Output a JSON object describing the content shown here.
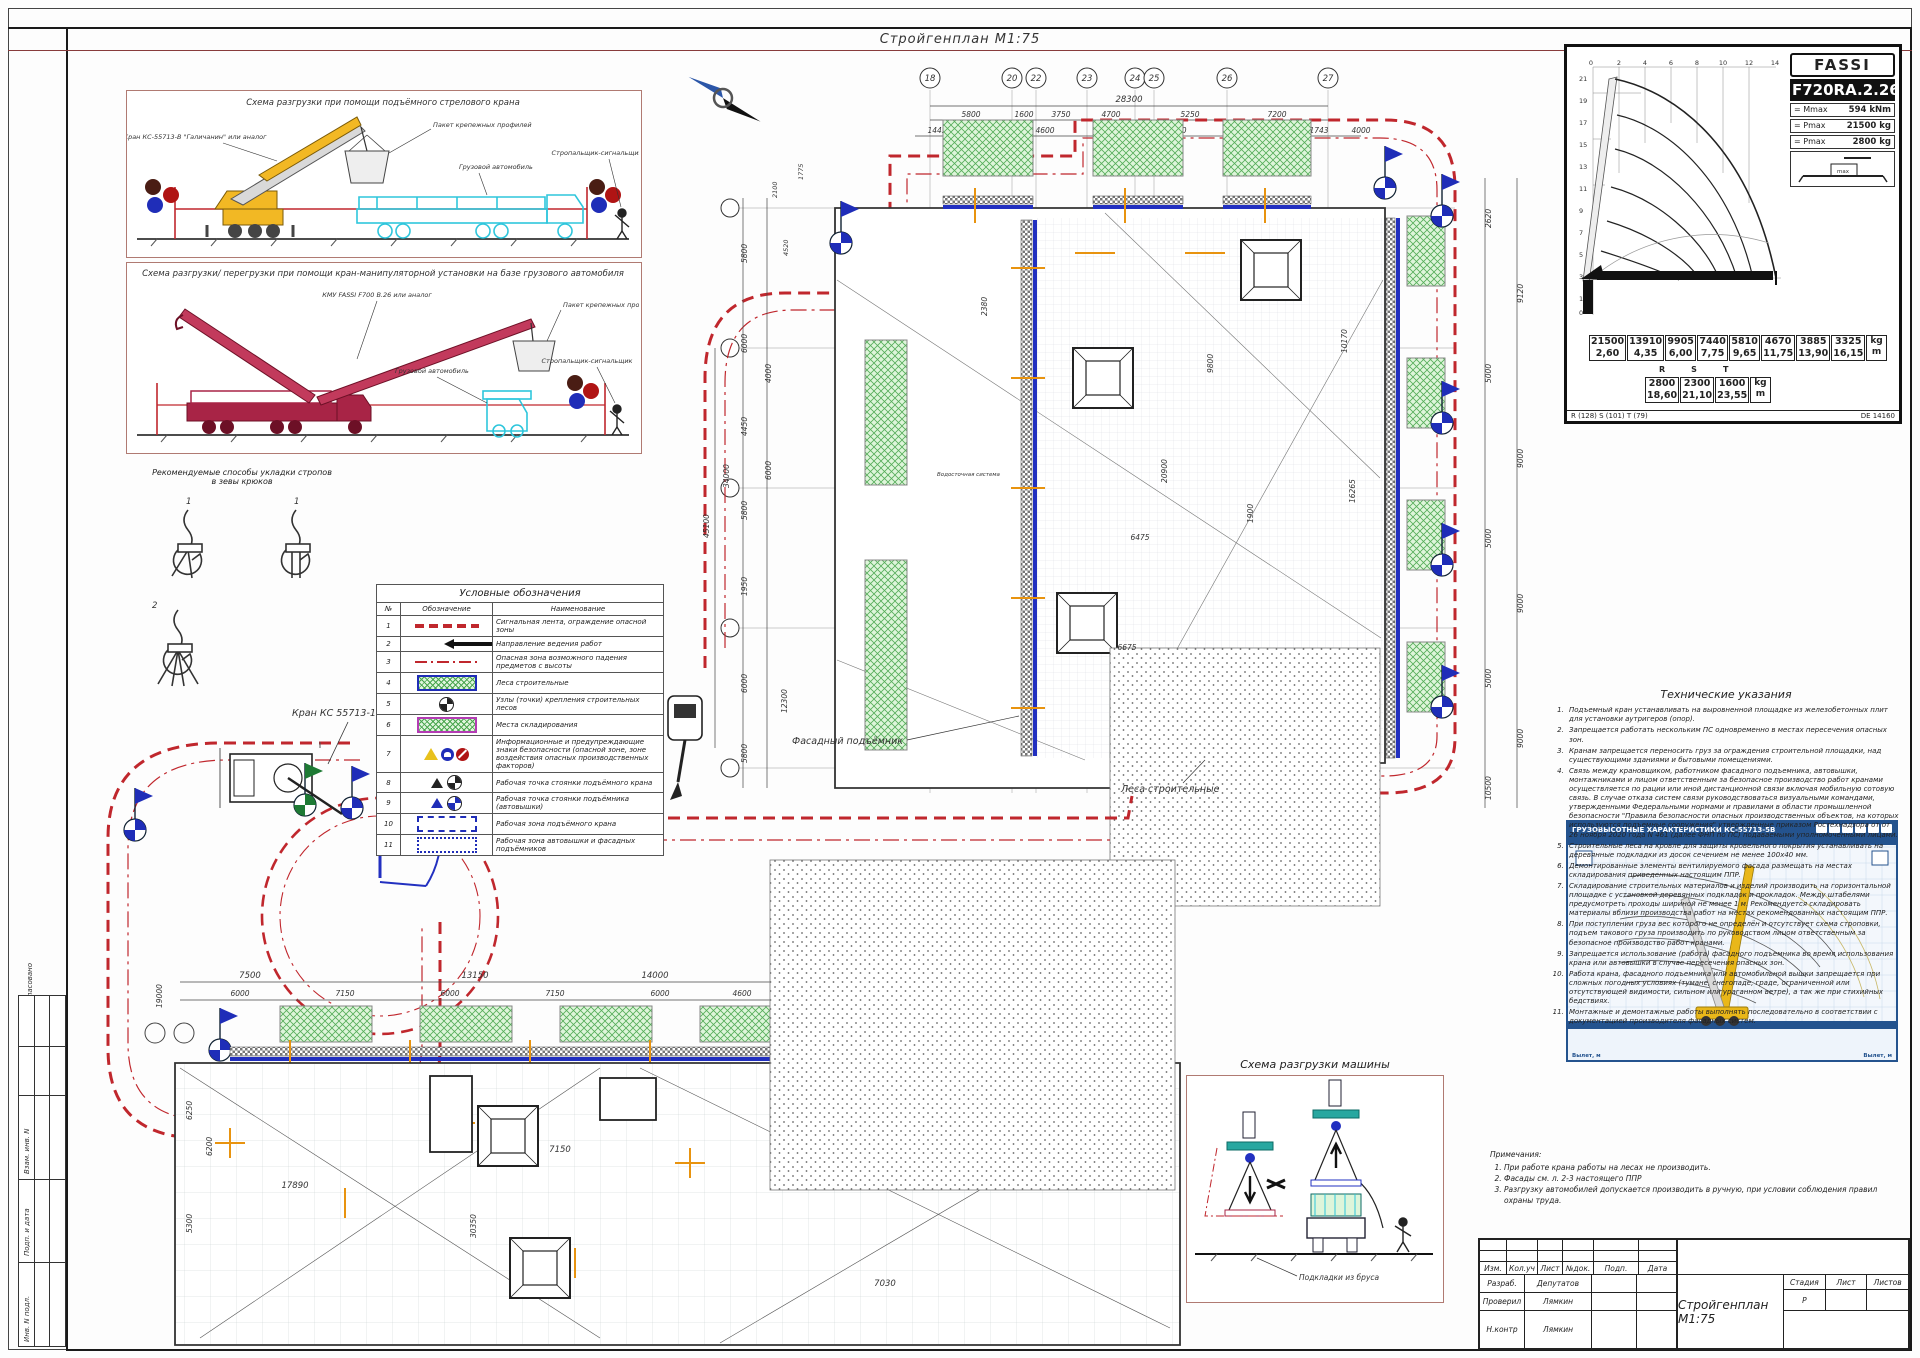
{
  "sheet": {
    "title": "Стройгенплан М1:75"
  },
  "side_stamp": {
    "labels": [
      "Согласовано",
      "Гл. спец.",
      "Взам. инв. N",
      "Подп. и дата",
      "Инв. N подл."
    ]
  },
  "schemes": {
    "s1": {
      "title": "Схема разгрузки при помощи подъёмного стрелового крана",
      "crane": "Кран КС-55713-В \"Галичанин\" или аналог",
      "package": "Пакет крепежных профилей",
      "truck": "Грузовой автомобиль",
      "rigger": "Стропальщик-сигнальщик"
    },
    "s2": {
      "title": "Схема разгрузки/ перегрузки при помощи кран-манипуляторной установки на базе грузового автомобиля",
      "crane": "КМУ FASSI F700 B.26 или аналог",
      "package": "Пакет крепежных профилей",
      "truck": "Грузовой автомобиль",
      "rigger": "Стропальщик-сигнальщик"
    }
  },
  "sling": {
    "title1": "Рекомендуемые способы укладки стропов",
    "title2": "в зевы крюков",
    "fig1": "1",
    "fig2": "1",
    "fig3": "2"
  },
  "legend": {
    "title": "Условные обозначения",
    "col_num": "№",
    "col_sym": "Обозначение",
    "col_name": "Наименование",
    "rows": [
      {
        "n": "1",
        "name": "Сигнальная лента, ограждение опасной зоны"
      },
      {
        "n": "2",
        "name": "Направление ведения работ"
      },
      {
        "n": "3",
        "name": "Опасная зона возможного падения предметов с высоты"
      },
      {
        "n": "4",
        "name": "Леса строительные"
      },
      {
        "n": "5",
        "name": "Узлы (точки) крепления строительных лесов"
      },
      {
        "n": "6",
        "name": "Места складирования"
      },
      {
        "n": "7",
        "name": "Информационные и предупреждающие знаки безопасности (опасной зоне, зоне воздействия опасных производственных факторов)"
      },
      {
        "n": "8",
        "name": "Рабочая точка стоянки подъёмного крана"
      },
      {
        "n": "9",
        "name": "Рабочая точка стоянки подъёмника (автовышки)"
      },
      {
        "n": "10",
        "name": "Рабочая зона подъёмного крана"
      },
      {
        "n": "11",
        "name": "Рабочая зона автовышки и фасадных подъёмников"
      }
    ]
  },
  "fassi": {
    "brand": "FASSI",
    "model": "F720RA.2.26",
    "spec1_l": "= Mmax",
    "spec1_v": "594 kNm",
    "spec2_l": "= Pmax",
    "spec2_v": "21500 kg",
    "spec3_l": "= Pmax",
    "spec3_v": "2800 kg",
    "outr": "max",
    "x_ticks": [
      "0",
      "2",
      "4",
      "6",
      "8",
      "10",
      "12",
      "14"
    ],
    "y_ticks": [
      "21",
      "19",
      "17",
      "15",
      "13",
      "11",
      "9",
      "7",
      "5",
      "3",
      "1",
      "0"
    ],
    "main_kg": [
      "21500",
      "13910",
      "9905",
      "7440",
      "5810",
      "4670",
      "3885",
      "3325"
    ],
    "main_m": [
      "2,60",
      "4,35",
      "6,00",
      "7,75",
      "9,65",
      "11,75",
      "13,90",
      "16,15"
    ],
    "unit_kg": "kg",
    "unit_m": "m",
    "rst": [
      "R",
      "S",
      "T"
    ],
    "rst_kg": [
      "2800",
      "2300",
      "1600"
    ],
    "rst_m": [
      "18,60",
      "21,10",
      "23,55"
    ],
    "foot_l": "R (128) S (101) T (79)",
    "foot_r": "DE 14160"
  },
  "chart2": {
    "title": "ГРУЗОВЫСОТНЫЕ ХАРАКТЕРИСТИКИ КС-55713-5В",
    "corner_l": "Вылет, м",
    "corner_r": "Вылет, м"
  },
  "tech": {
    "title": "Технические указания",
    "items": [
      "Подъемный кран устанавливать на выровненной площадке из железобетонных плит для установки аутригеров (опор).",
      "Запрещается работать нескольким ПС одновременно в местах пересечения опасных зон.",
      "Кранам запрещается переносить груз за ограждения строительной площадки, над существующими зданиями и бытовыми помещениями.",
      "Связь между крановщиком, работником фасадного подъемника, автовышки, монтажниками и лицом ответственным за безопасное производство работ кранами осуществляется по рации или иной дистанционной связи включая мобильную сотовую связь. В случае отказа систем связи руководствоваться визуальными командами, утвержденными Федеральными нормами и правилами в области промышленной безопасности \"Правила безопасности опасных производственных объектов, на которых используются подъемные сооружения\" утвержденные приказом Ростехнадзора от от 26 ноября 2020 года N 461 (далее ФНП по ПС) подаваемыми уполномоченными лицами.",
      "Строительные леса на кровле для защиты кровельного покрытия устанавливать на деревянные подкладки из досок сечением не менее 100х40 мм.",
      "Демонтированные элементы вентилируемого фасада размещать на местах складирования приведенных настоящим ППР.",
      "Складирование строительных материалов и изделий производить на горизонтальной площадке с установкой деревянных подкладок и прокладок. Между штабелями предусмотреть проходы шириной не менее 1 м. Рекомендуется складировать материалы вблизи производства работ на местах рекомендованных настоящим ППР.",
      "При поступлении груза вес которого не определён и отсутствует схема строповки, подъем такового груза производить по руководством лицом ответственным за безопасное производство работ кранами.",
      "Запрещается использование (работа) фасадного подъемника во время использования крана или автовышки в случае пересечения опасных зон.",
      "Работа крана, фасадного подъемника или автомобильной вышки запрещается при сложных погодных условиях (тумане, снегопаде, граде, ограниченной или отсутствующей видимости, сильном или ураганном ветре), а так же при стихийных бедствиях.",
      "Монтажные и демонтажные работы выполнять последовательно в соответствии с документацией производителя фасадных систем."
    ]
  },
  "remarks": {
    "title": "Примечания:",
    "items": [
      "При работе крана работы на лесах не производить.",
      "Фасады см. л. 2-3 настоящего ППР",
      "Разгрузку автомобилей допускается производить в ручную, при условии соблюдения правил охраны труда."
    ]
  },
  "unload": {
    "title": "Схема разгрузки машины",
    "pad_label": "Подкладки из бруса"
  },
  "stamp": {
    "cols": [
      "Изм.",
      "Кол.уч",
      "Лист",
      "№док.",
      "Подп.",
      "Дата"
    ],
    "r1_role": "Разраб.",
    "r1_name": "Депутатов",
    "r2_role": "Проверил",
    "r2_name": "Лямкин",
    "r3_role": "Н.контр",
    "r3_name": "Лямкин",
    "stage_l": "Стадия",
    "sheet_l": "Лист",
    "sheets_l": "Листов",
    "stage_v": "Р",
    "doc_title": "Стройгенплан М1:75"
  },
  "plan": {
    "axes_top": [
      "18",
      "20",
      "22",
      "23",
      "24",
      "25",
      "26",
      "27"
    ],
    "total": "28300",
    "extra_right": "4000",
    "row1": [
      "5800",
      "1600",
      "3750",
      "4700",
      "5250",
      "7200"
    ],
    "row2": [
      "1445",
      "6000",
      "4600",
      "6000",
      "3400",
      "6000",
      "1743"
    ],
    "right": [
      "2620",
      "9120",
      "5000",
      "9000",
      "5000",
      "9000",
      "5000",
      "9000",
      "10500"
    ],
    "left": [
      "2100",
      "1775",
      "4520",
      "5800",
      "6000",
      "4450",
      "5800",
      "4000",
      "6000",
      "1950",
      "34000",
      "45100",
      "6000",
      "5800",
      "12300"
    ],
    "inner": [
      "2380",
      "20900",
      "16265",
      "6475",
      "1900",
      "9800",
      "6675",
      "10170"
    ],
    "labels": {
      "facade": "Фасадный подъёмник",
      "scaff": "Леса строительные",
      "crane": "Кран КС 55713-1В",
      "drain": "Водосточная система"
    }
  },
  "plan2": {
    "top": [
      "7500",
      "13150",
      "14000"
    ],
    "row2": [
      "6000",
      "7150",
      "6000",
      "7150",
      "6000",
      "4600"
    ],
    "left": [
      "19000",
      "6250",
      "6200",
      "5300"
    ],
    "inner": [
      "7150",
      "17890",
      "7030",
      "30350"
    ]
  }
}
